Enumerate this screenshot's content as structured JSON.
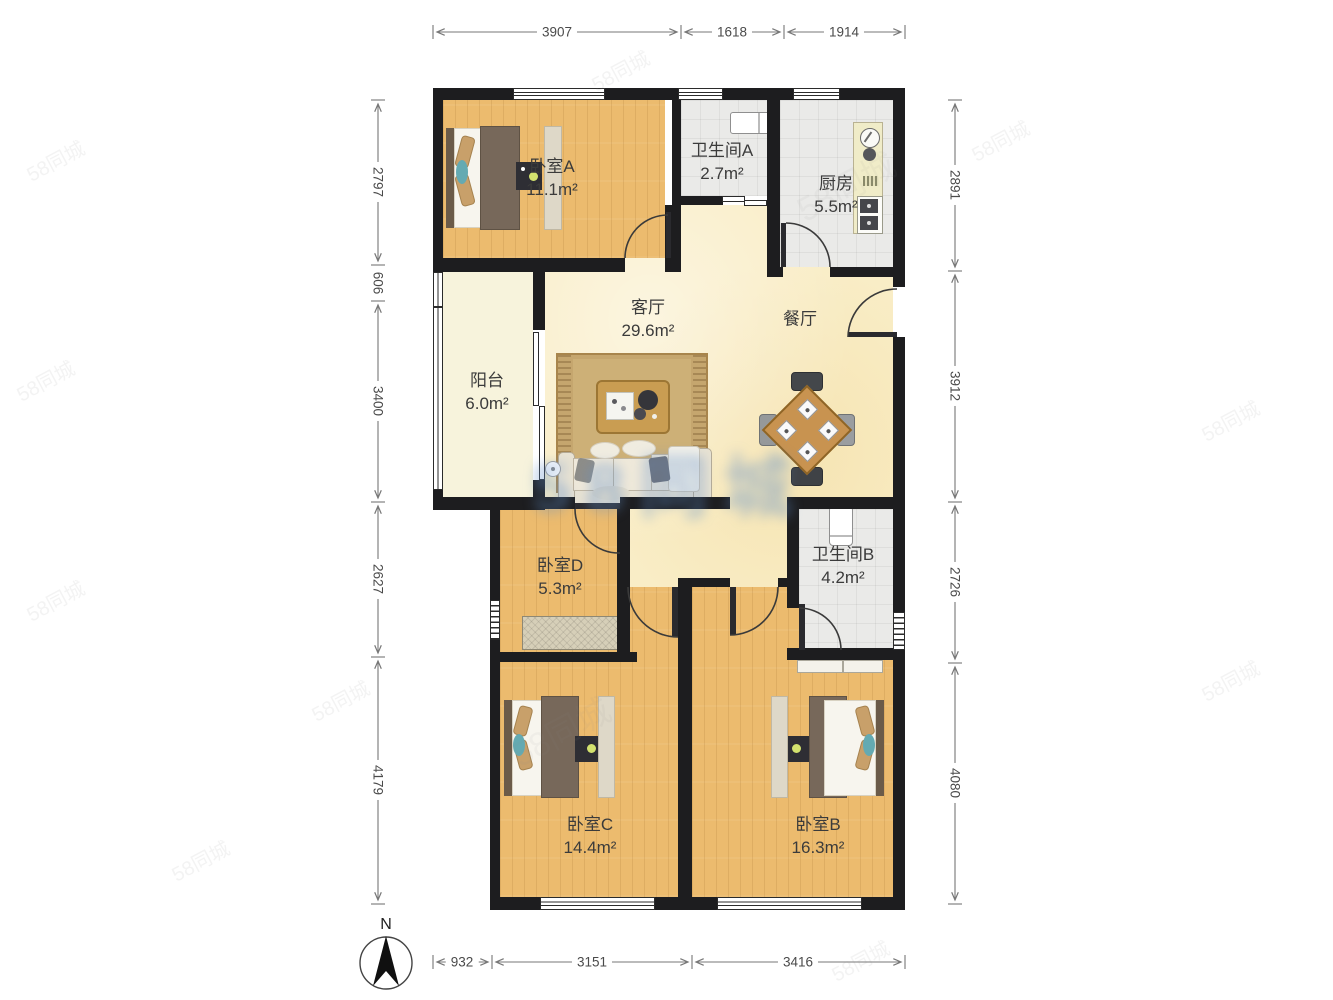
{
  "rooms": {
    "bedroomA": {
      "name": "卧室A",
      "area": "11.1m²"
    },
    "bathA": {
      "name": "卫生间A",
      "area": "2.7m²"
    },
    "kitchen": {
      "name": "厨房",
      "area": "5.5m²"
    },
    "living": {
      "name": "客厅",
      "area": "29.6m²"
    },
    "dining": {
      "name": "餐厅"
    },
    "balcony": {
      "name": "阳台",
      "area": "6.0m²"
    },
    "bedroomD": {
      "name": "卧室D",
      "area": "5.3m²"
    },
    "bathB": {
      "name": "卫生间B",
      "area": "4.2m²"
    },
    "bedroomC": {
      "name": "卧室C",
      "area": "14.4m²"
    },
    "bedroomB": {
      "name": "卧室B",
      "area": "16.3m²"
    }
  },
  "dimensions_mm": {
    "top": [
      "3907",
      "1618",
      "1914"
    ],
    "left": [
      "2797",
      "606",
      "3400",
      "2627",
      "4179"
    ],
    "right": [
      "2891",
      "3912",
      "2726",
      "4080"
    ],
    "bottom": [
      "932",
      "3151",
      "3416"
    ]
  },
  "compass": {
    "label": "N"
  },
  "watermark": {
    "text": "58同城"
  },
  "colors": {
    "wall": "#1d1d1f",
    "wood_floor": "#ecbb6e",
    "living_floor": "#f9edc6",
    "balcony_floor": "#f7f3dc",
    "tile_floor": "#eaeae8",
    "watermark_blue": "#608ec8"
  }
}
